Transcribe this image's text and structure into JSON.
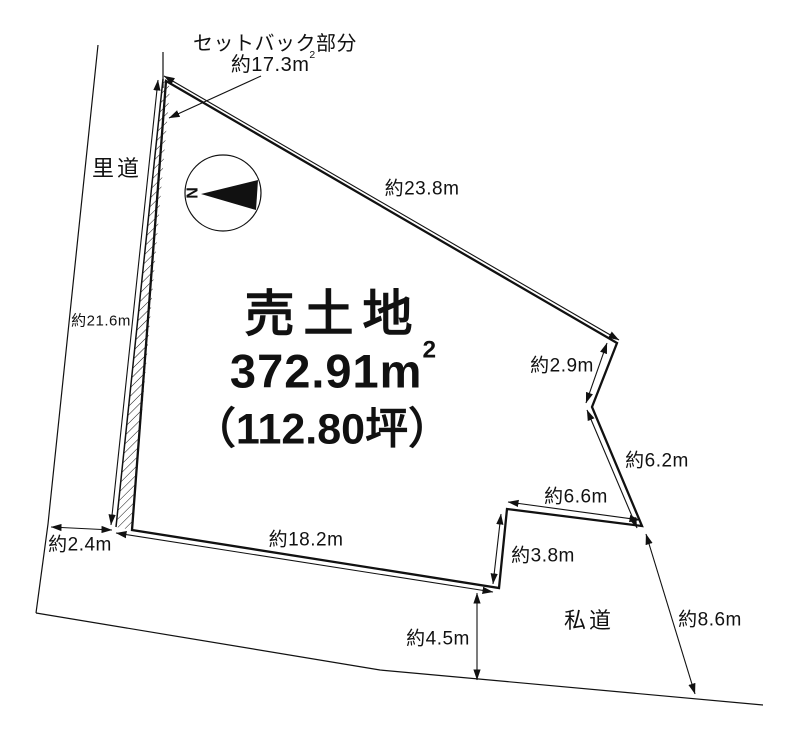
{
  "title_block": {
    "line1": "売土地",
    "area_value": "372.91m",
    "area_sup": "2",
    "tsubo": "（112.80坪）"
  },
  "setback_note": {
    "line1": "セットバック部分",
    "area_value": "約17.3m",
    "area_sup": "2"
  },
  "roads": {
    "west_road": "里道",
    "private_road": "私道"
  },
  "compass": {
    "north_label": "N"
  },
  "dimensions": {
    "west_edge": "約21.6m",
    "northeast_edge": "約23.8m",
    "east_edge_upper": "約2.9m",
    "east_edge_mid": "約6.2m",
    "southeast_edge_upper": "約6.6m",
    "southeast_edge_step": "約3.8m",
    "south_edge": "約18.2m",
    "west_road_width": "約2.4m",
    "private_road_width": "約4.5m",
    "private_road_length": "約8.6m"
  },
  "colors": {
    "line": "#111111",
    "background": "#ffffff"
  }
}
